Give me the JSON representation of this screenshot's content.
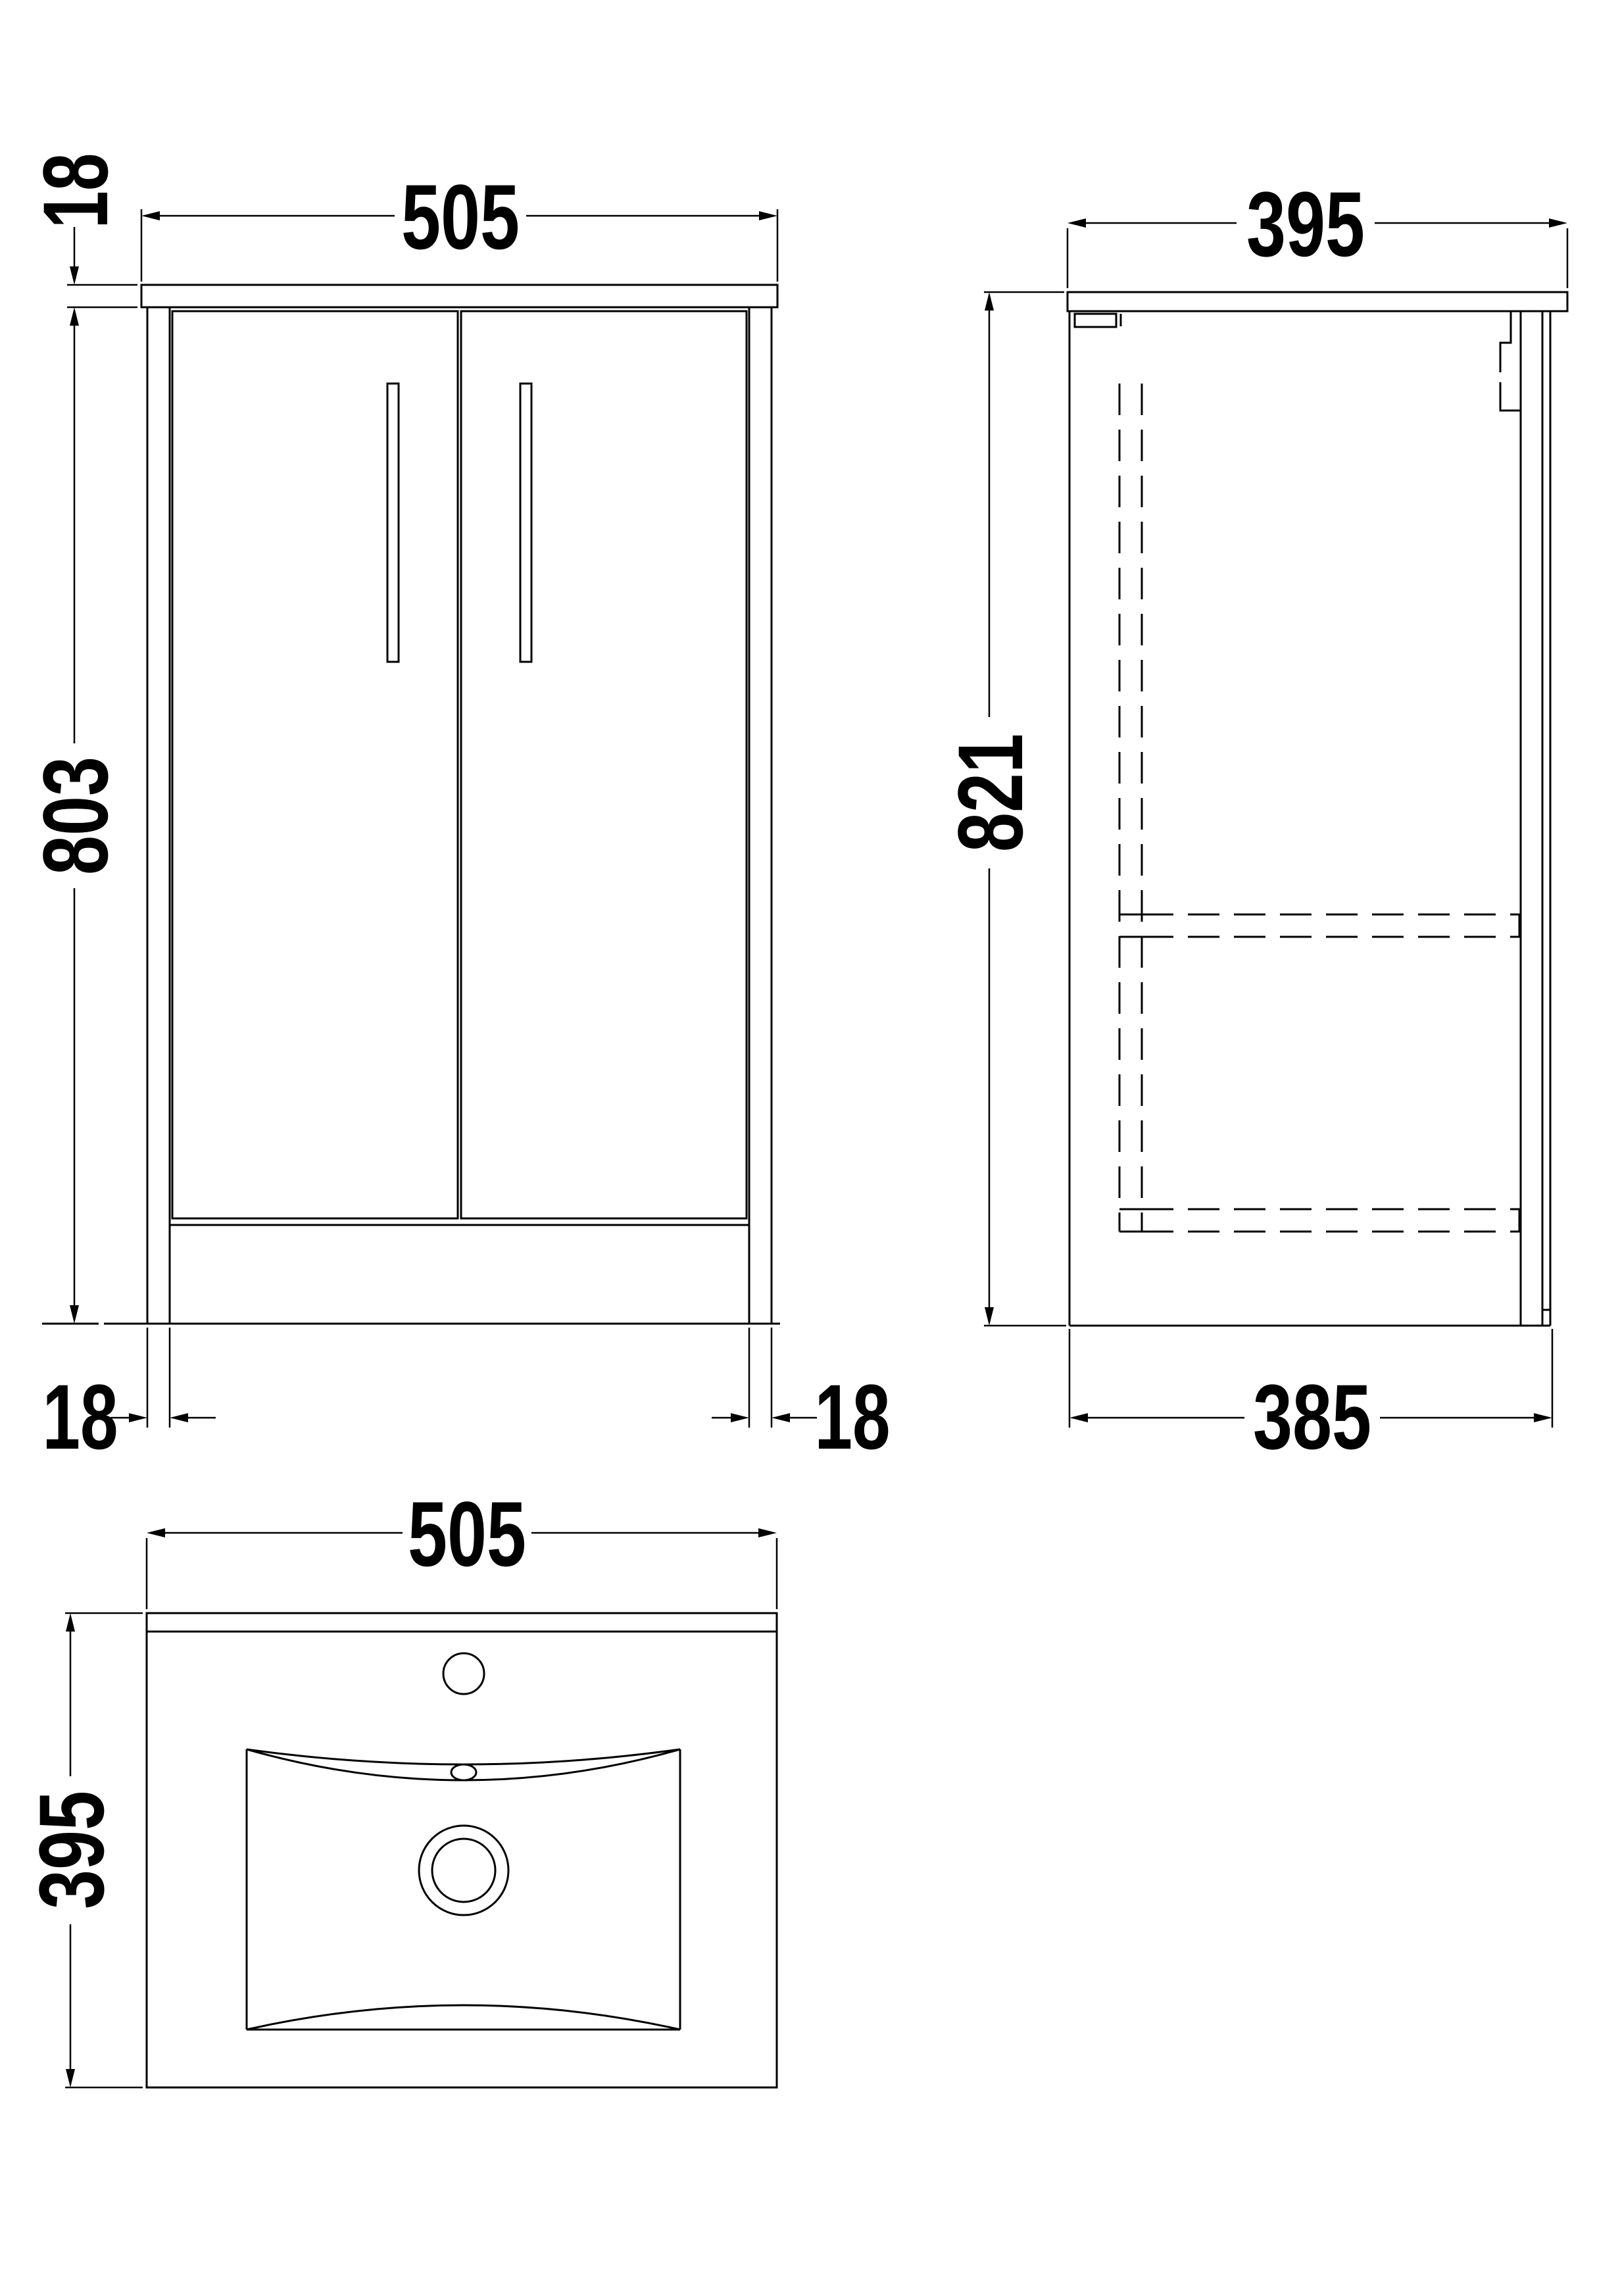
{
  "drawing": {
    "type": "technical-dimension-drawing",
    "subject": "two-door floor-standing vanity unit with basin",
    "background_color": "#ffffff",
    "line_color": "#000000",
    "views": {
      "front": {
        "width_label": "505",
        "counter_thickness_label": "18",
        "body_height_label": "803",
        "left_panel_thickness_label": "18",
        "right_panel_thickness_label": "18"
      },
      "side": {
        "depth_label": "395",
        "overall_height_label": "821",
        "base_depth_label": "385"
      },
      "plan": {
        "width_label": "505",
        "depth_label": "395"
      }
    },
    "dimensions_mm": {
      "front_width": 505,
      "counter_thickness": 18,
      "body_height": 803,
      "panel_thickness": 18,
      "side_depth": 395,
      "overall_height": 821,
      "base_depth": 385,
      "plan_width": 505,
      "plan_depth": 395
    }
  }
}
